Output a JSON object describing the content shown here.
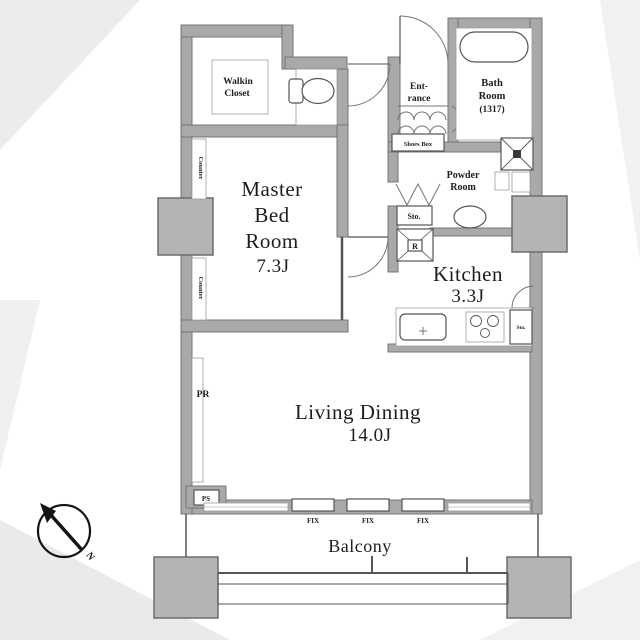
{
  "colors": {
    "wall": "#a9a9a9",
    "wall_border": "#757575",
    "pillar": "#b4b4b4",
    "line": "#555555",
    "text": "#1d1d1d"
  },
  "rooms": {
    "walkin_closet": {
      "lines": [
        "Walkin",
        "Closet"
      ]
    },
    "entrance": {
      "lines": [
        "Ent-",
        "rance"
      ]
    },
    "bath_room": {
      "lines": [
        "Bath",
        "Room",
        "(1317)"
      ]
    },
    "powder_room": {
      "lines": [
        "Powder",
        "Room"
      ]
    },
    "kitchen": {
      "lines": [
        "Kitchen",
        "3.3J"
      ]
    },
    "master_bed_room": {
      "lines": [
        "Master",
        "Bed",
        "Room",
        "7.3J"
      ]
    },
    "living_dining": {
      "lines": [
        "Living Dining",
        "14.0J"
      ]
    },
    "balcony": {
      "label": "Balcony"
    }
  },
  "labels": {
    "shoes_box": "Shoes Box",
    "hall_storage": "Sto.",
    "kitchen_storage": "Sto.",
    "refrigerator": "R",
    "pipe_rack": "PR",
    "pipe_space": "PS",
    "counter_upper": "Counter",
    "counter_lower": "Counter",
    "fix_windows": [
      "FIX",
      "FIX",
      "FIX"
    ],
    "compass_north": "N"
  }
}
